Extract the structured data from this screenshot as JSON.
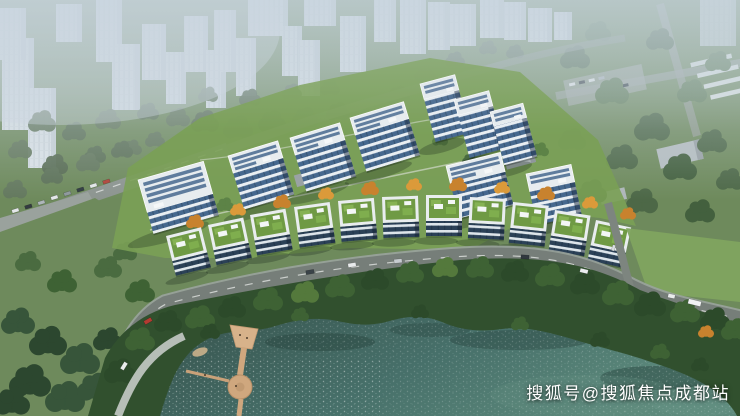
{
  "watermark": {
    "text": "搜狐号@搜狐焦点成都站"
  },
  "palette": {
    "haze": "#c6d2dc",
    "ghostBuilding": "#dde4e9",
    "cityTree": "#64795e",
    "parkGrass": "#6e8a5c",
    "lawn": "#7aa055",
    "brightField": "#7fa45f",
    "forest": "#31502e",
    "treeDark": "#2c4a2a",
    "treeMid": "#3e6234",
    "treeLight": "#54793c",
    "autumnOrange": "#c8822e",
    "road": "#767e79",
    "roadCasing": "#9aa39d",
    "upperRoad": "#8d9590",
    "waterDark": "#3a5a54",
    "waterLight": "#5d8a7c",
    "facadeGlass": "#46688e",
    "facadeSlab": "#e9eef2",
    "greenRoof": "#6f9a44",
    "pierWood": "#cfa77e",
    "white": "#ffffff"
  }
}
